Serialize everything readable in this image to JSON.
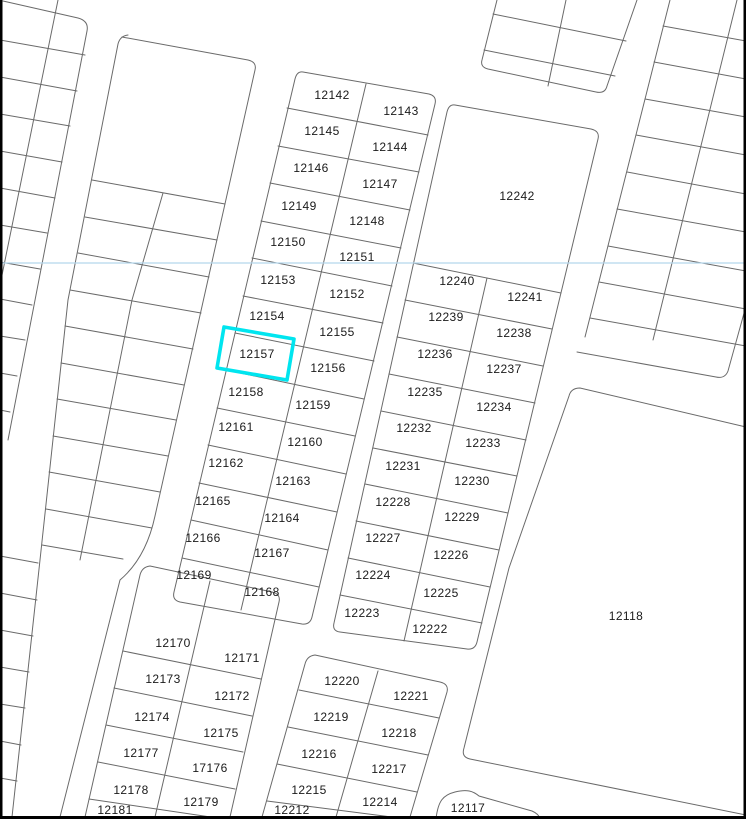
{
  "map": {
    "description": "cadastral-parcel-map",
    "highlighted_parcel": "12157",
    "colors": {
      "background": "#ffffff",
      "parcel_line": "#6a6a6a",
      "label": "#1a1a1a",
      "highlight": "#00e5ef",
      "reference_line": "#b5d6ec",
      "border": "#000000"
    },
    "parcels": [
      {
        "id": "12142",
        "x": 332,
        "y": 95
      },
      {
        "id": "12145",
        "x": 322,
        "y": 131
      },
      {
        "id": "12146",
        "x": 311,
        "y": 168
      },
      {
        "id": "12149",
        "x": 299,
        "y": 206
      },
      {
        "id": "12150",
        "x": 288,
        "y": 242
      },
      {
        "id": "12153",
        "x": 278,
        "y": 280
      },
      {
        "id": "12154",
        "x": 267,
        "y": 316
      },
      {
        "id": "12157",
        "x": 257,
        "y": 354
      },
      {
        "id": "12158",
        "x": 246,
        "y": 392
      },
      {
        "id": "12161",
        "x": 236,
        "y": 427
      },
      {
        "id": "12162",
        "x": 226,
        "y": 463
      },
      {
        "id": "12165",
        "x": 213,
        "y": 501
      },
      {
        "id": "12166",
        "x": 203,
        "y": 538
      },
      {
        "id": "12169",
        "x": 194,
        "y": 575
      },
      {
        "id": "12143",
        "x": 401,
        "y": 111
      },
      {
        "id": "12144",
        "x": 390,
        "y": 147
      },
      {
        "id": "12147",
        "x": 380,
        "y": 184
      },
      {
        "id": "12148",
        "x": 367,
        "y": 221
      },
      {
        "id": "12151",
        "x": 357,
        "y": 257
      },
      {
        "id": "12152",
        "x": 347,
        "y": 294
      },
      {
        "id": "12155",
        "x": 337,
        "y": 332
      },
      {
        "id": "12156",
        "x": 328,
        "y": 368
      },
      {
        "id": "12159",
        "x": 313,
        "y": 405
      },
      {
        "id": "12160",
        "x": 305,
        "y": 442
      },
      {
        "id": "12163",
        "x": 293,
        "y": 481
      },
      {
        "id": "12164",
        "x": 282,
        "y": 518
      },
      {
        "id": "12167",
        "x": 272,
        "y": 553
      },
      {
        "id": "12168",
        "x": 262,
        "y": 592
      },
      {
        "id": "12242",
        "x": 517,
        "y": 196
      },
      {
        "id": "12240",
        "x": 457,
        "y": 281
      },
      {
        "id": "12239",
        "x": 446,
        "y": 317
      },
      {
        "id": "12236",
        "x": 435,
        "y": 354
      },
      {
        "id": "12235",
        "x": 425,
        "y": 392
      },
      {
        "id": "12232",
        "x": 414,
        "y": 428
      },
      {
        "id": "12231",
        "x": 403,
        "y": 466
      },
      {
        "id": "12228",
        "x": 393,
        "y": 502
      },
      {
        "id": "12227",
        "x": 383,
        "y": 538
      },
      {
        "id": "12224",
        "x": 373,
        "y": 575
      },
      {
        "id": "12223",
        "x": 362,
        "y": 613
      },
      {
        "id": "12241",
        "x": 525,
        "y": 297
      },
      {
        "id": "12238",
        "x": 514,
        "y": 333
      },
      {
        "id": "12237",
        "x": 504,
        "y": 369
      },
      {
        "id": "12234",
        "x": 494,
        "y": 407
      },
      {
        "id": "12233",
        "x": 483,
        "y": 443
      },
      {
        "id": "12230",
        "x": 472,
        "y": 481
      },
      {
        "id": "12229",
        "x": 462,
        "y": 517
      },
      {
        "id": "12226",
        "x": 451,
        "y": 555
      },
      {
        "id": "12225",
        "x": 441,
        "y": 593
      },
      {
        "id": "12222",
        "x": 430,
        "y": 629
      },
      {
        "id": "12118",
        "x": 626,
        "y": 616
      },
      {
        "id": "12117",
        "x": 468,
        "y": 808
      },
      {
        "id": "12170",
        "x": 173,
        "y": 643
      },
      {
        "id": "12173",
        "x": 163,
        "y": 679
      },
      {
        "id": "12174",
        "x": 152,
        "y": 717
      },
      {
        "id": "12177",
        "x": 141,
        "y": 753
      },
      {
        "id": "12178",
        "x": 131,
        "y": 790
      },
      {
        "id": "12181",
        "x": 115,
        "y": 810
      },
      {
        "id": "12171",
        "x": 242,
        "y": 658
      },
      {
        "id": "12172",
        "x": 232,
        "y": 696
      },
      {
        "id": "12175",
        "x": 221,
        "y": 733
      },
      {
        "id": "17176",
        "x": 210,
        "y": 768
      },
      {
        "id": "12179",
        "x": 201,
        "y": 802
      },
      {
        "id": "12220",
        "x": 342,
        "y": 681
      },
      {
        "id": "12219",
        "x": 331,
        "y": 717
      },
      {
        "id": "12216",
        "x": 319,
        "y": 754
      },
      {
        "id": "12215",
        "x": 309,
        "y": 790
      },
      {
        "id": "12212",
        "x": 292,
        "y": 810
      },
      {
        "id": "12221",
        "x": 411,
        "y": 696
      },
      {
        "id": "12218",
        "x": 399,
        "y": 733
      },
      {
        "id": "12217",
        "x": 389,
        "y": 769
      },
      {
        "id": "12214",
        "x": 380,
        "y": 802
      }
    ]
  }
}
